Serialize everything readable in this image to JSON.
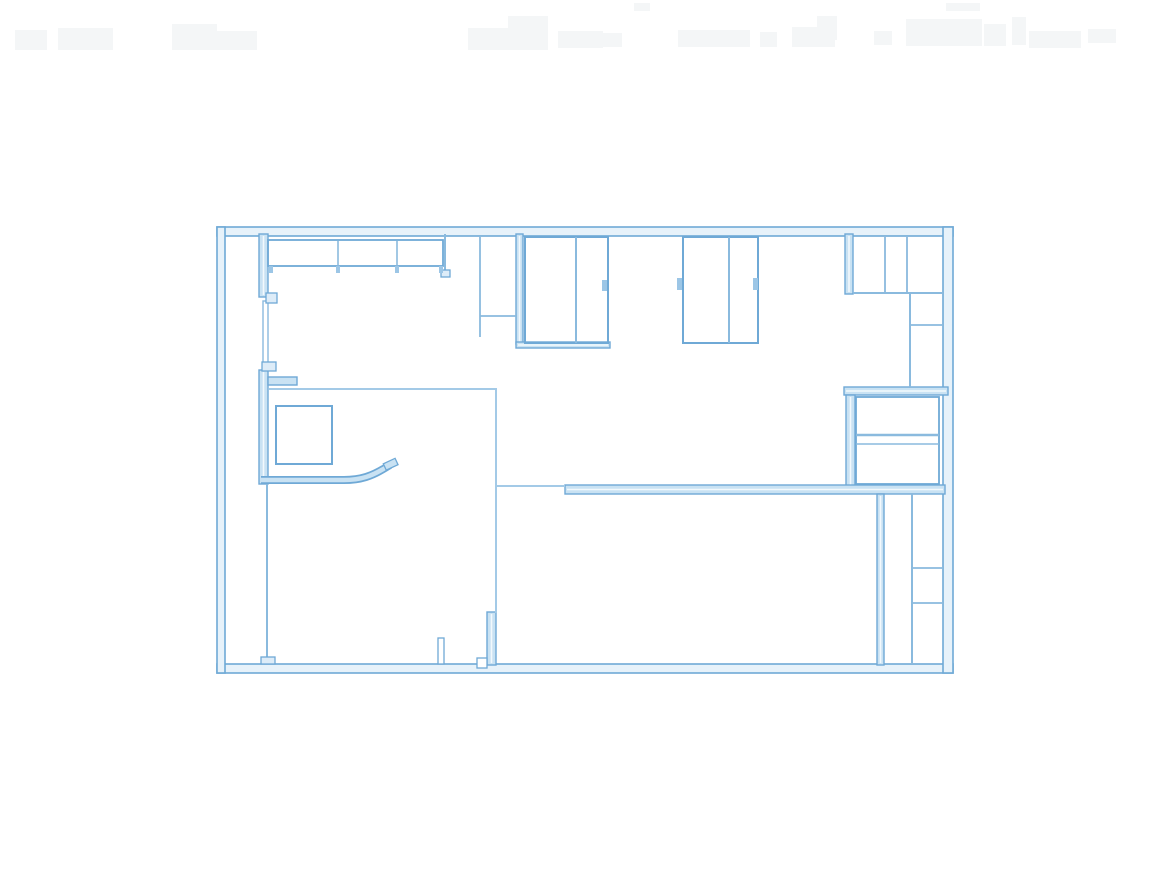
{
  "canvas": {
    "width": 1168,
    "height": 880
  },
  "colors": {
    "background": "#ffffff",
    "wall_edge": "#6fa9d6",
    "wall_fill": "#c9e2f3",
    "wall_center_highlight": "#f2f9fd",
    "outer_wall_fill": "#e7f2fa",
    "thin_line": "#8abade",
    "thin_line_light": "#a3cae7",
    "tick_fill": "#9cc6e6",
    "nub_fill": "#ddecf8",
    "smudge": "#f4f6f7"
  },
  "plan": {
    "outer_walls": [
      {
        "n": "outer-wall-top",
        "r": [
          217,
          227,
          736,
          9
        ]
      },
      {
        "n": "outer-wall-bottom",
        "r": [
          217,
          664,
          736,
          9
        ]
      },
      {
        "n": "outer-wall-left",
        "r": [
          217,
          227,
          8,
          446
        ]
      },
      {
        "n": "outer-wall-right",
        "r": [
          943,
          227,
          10,
          446
        ]
      }
    ],
    "thick_walls": [
      {
        "n": "left-interior-wall-upper",
        "r": [
          259,
          234,
          9,
          63
        ]
      },
      {
        "n": "left-interior-wall-lower",
        "r": [
          259,
          370,
          9,
          114
        ]
      },
      {
        "n": "left-wall-jog",
        "r": [
          268,
          377,
          29,
          8
        ]
      },
      {
        "n": "double-wall-x517",
        "r": [
          516,
          234,
          7,
          110
        ]
      },
      {
        "n": "closet1-bottom-bar",
        "r": [
          516,
          342,
          94,
          6
        ]
      },
      {
        "n": "topright-interior-wall",
        "r": [
          845,
          234,
          8,
          60
        ]
      },
      {
        "n": "midright-room-top-wall",
        "r": [
          844,
          387,
          104,
          8
        ]
      },
      {
        "n": "midright-room-left-wall",
        "r": [
          846,
          395,
          9,
          93
        ]
      },
      {
        "n": "main-horizontal-wall",
        "r": [
          565,
          485,
          380,
          9
        ]
      },
      {
        "n": "bottomright-vertical-wall",
        "r": [
          877,
          494,
          7,
          171
        ]
      },
      {
        "n": "bottommid-vertical-wall",
        "r": [
          487,
          612,
          9,
          53
        ]
      }
    ],
    "thin_wall_outlines": [
      {
        "n": "left-wall-thin-segment",
        "r": [
          263,
          301,
          5,
          62
        ],
        "sw": 1.4
      }
    ],
    "outline_rects": [
      {
        "n": "cabinet-row",
        "r": [
          268,
          240,
          175,
          26
        ],
        "sw": 1.8
      },
      {
        "n": "closet-square",
        "r": [
          276,
          406,
          56,
          58
        ],
        "sw": 2
      },
      {
        "n": "sliding-closet-1",
        "r": [
          525,
          237,
          83,
          106
        ],
        "sw": 2
      },
      {
        "n": "sliding-closet-2",
        "r": [
          683,
          237,
          75,
          106
        ],
        "sw": 2
      },
      {
        "n": "midright-room-box",
        "r": [
          856,
          397,
          83,
          87
        ],
        "sw": 1.8
      }
    ],
    "nubs": [
      {
        "n": "left-wall-nub-upper",
        "r": [
          266,
          293,
          11,
          10
        ],
        "f": true
      },
      {
        "n": "left-wall-nub-lower",
        "r": [
          262,
          362,
          14,
          9
        ],
        "f": true
      },
      {
        "n": "left-line-foot",
        "r": [
          261,
          657,
          14,
          7
        ],
        "f": true
      },
      {
        "n": "cabinet-stub-foot",
        "r": [
          441,
          270,
          9,
          7
        ],
        "f": true
      },
      {
        "n": "door-stop-notch",
        "r": [
          477,
          658,
          10,
          10
        ],
        "f": false
      },
      {
        "n": "door-jamb-post",
        "r": [
          438,
          638,
          6,
          26
        ],
        "f": false
      }
    ],
    "lines": [
      {
        "n": "leftroom-top-line",
        "p": [
          269,
          389,
          497,
          389
        ],
        "w": 2,
        "light": true
      },
      {
        "n": "leftroom-right-line",
        "p": [
          496,
          389,
          496,
          613
        ],
        "w": 2,
        "light": true
      },
      {
        "n": "leftroom-left-line",
        "p": [
          267,
          484,
          267,
          662
        ],
        "w": 2,
        "light": false
      },
      {
        "n": "cabinet-divider-1",
        "p": [
          338,
          241,
          338,
          266
        ],
        "w": 1.6,
        "light": false
      },
      {
        "n": "cabinet-divider-2",
        "p": [
          397,
          241,
          397,
          266
        ],
        "w": 1.6,
        "light": false
      },
      {
        "n": "cabinet-end-stub",
        "p": [
          445,
          234,
          445,
          272
        ],
        "w": 2,
        "light": false
      },
      {
        "n": "window-block-vertical",
        "p": [
          480,
          237,
          480,
          337
        ],
        "w": 1.8,
        "light": false
      },
      {
        "n": "window-block-horizontal",
        "p": [
          480,
          316,
          517,
          316
        ],
        "w": 1.8,
        "light": false
      },
      {
        "n": "closet1-divider",
        "p": [
          576,
          237,
          576,
          343
        ],
        "w": 2,
        "light": false
      },
      {
        "n": "closet2-divider",
        "p": [
          729,
          237,
          729,
          343
        ],
        "w": 2,
        "light": false
      },
      {
        "n": "topright-shelf-bottom",
        "p": [
          853,
          293,
          943,
          293
        ],
        "w": 2,
        "light": false
      },
      {
        "n": "topright-divider-1",
        "p": [
          885,
          237,
          885,
          293
        ],
        "w": 1.8,
        "light": false
      },
      {
        "n": "topright-divider-2",
        "p": [
          907,
          237,
          907,
          293
        ],
        "w": 1.8,
        "light": false
      },
      {
        "n": "topright-column-line",
        "p": [
          910,
          294,
          910,
          387
        ],
        "w": 2,
        "light": false
      },
      {
        "n": "topright-column-shelf",
        "p": [
          910,
          325,
          943,
          325
        ],
        "w": 1.8,
        "light": false
      },
      {
        "n": "midright-room-band-1",
        "p": [
          856,
          435,
          939,
          435
        ],
        "w": 2.4,
        "light": false
      },
      {
        "n": "midright-room-band-2",
        "p": [
          856,
          444,
          939,
          444
        ],
        "w": 1.6,
        "light": false
      },
      {
        "n": "main-wall-thin-lead",
        "p": [
          497,
          486,
          565,
          486
        ],
        "w": 2,
        "light": true
      },
      {
        "n": "bottomright-inner-line",
        "p": [
          912,
          494,
          912,
          663
        ],
        "w": 2,
        "light": false
      },
      {
        "n": "bottomright-shelf-1",
        "p": [
          912,
          568,
          943,
          568
        ],
        "w": 1.8,
        "light": false
      },
      {
        "n": "bottomright-shelf-2",
        "p": [
          912,
          603,
          943,
          603
        ],
        "w": 1.8,
        "light": false
      }
    ],
    "ticks": [
      {
        "n": "closet1-handle",
        "r": [
          602,
          280,
          5,
          11
        ]
      },
      {
        "n": "closet2-handle-left",
        "r": [
          677,
          278,
          5,
          12
        ]
      },
      {
        "n": "closet2-handle-right",
        "r": [
          753,
          278,
          5,
          12
        ]
      },
      {
        "n": "cabinet-tick-1",
        "r": [
          269,
          266,
          4,
          7
        ]
      },
      {
        "n": "cabinet-tick-2",
        "r": [
          336,
          266,
          4,
          7
        ]
      },
      {
        "n": "cabinet-tick-3",
        "r": [
          395,
          266,
          4,
          7
        ]
      },
      {
        "n": "cabinet-tick-4",
        "r": [
          439,
          266,
          4,
          7
        ]
      }
    ],
    "curved_wall": {
      "n": "curved-interior-wall",
      "path": "M261 480 L344 480 C361 480 372 476 385 468 L390 465",
      "outer_width": 8,
      "inner_width": 4.5,
      "cap": {
        "r": [
          384,
          461,
          13,
          7
        ],
        "rotate": [
          -25,
          390,
          464
        ]
      }
    },
    "smudges": [
      {
        "r": [
          15,
          30,
          32,
          20
        ]
      },
      {
        "r": [
          58,
          28,
          55,
          22
        ]
      },
      {
        "r": [
          172,
          24,
          45,
          26
        ]
      },
      {
        "r": [
          215,
          31,
          42,
          19
        ]
      },
      {
        "r": [
          468,
          28,
          65,
          22
        ]
      },
      {
        "r": [
          508,
          16,
          40,
          34
        ]
      },
      {
        "r": [
          558,
          31,
          45,
          17
        ]
      },
      {
        "r": [
          584,
          33,
          38,
          14
        ]
      },
      {
        "r": [
          634,
          3,
          16,
          8
        ]
      },
      {
        "r": [
          678,
          30,
          72,
          17
        ]
      },
      {
        "r": [
          760,
          32,
          17,
          15
        ]
      },
      {
        "r": [
          792,
          27,
          43,
          20
        ]
      },
      {
        "r": [
          817,
          16,
          20,
          24
        ]
      },
      {
        "r": [
          874,
          31,
          18,
          14
        ]
      },
      {
        "r": [
          906,
          19,
          76,
          27
        ]
      },
      {
        "r": [
          946,
          3,
          34,
          8
        ]
      },
      {
        "r": [
          984,
          24,
          22,
          22
        ]
      },
      {
        "r": [
          1012,
          17,
          14,
          28
        ]
      },
      {
        "r": [
          1029,
          31,
          52,
          17
        ]
      },
      {
        "r": [
          1088,
          29,
          28,
          14
        ]
      }
    ]
  }
}
